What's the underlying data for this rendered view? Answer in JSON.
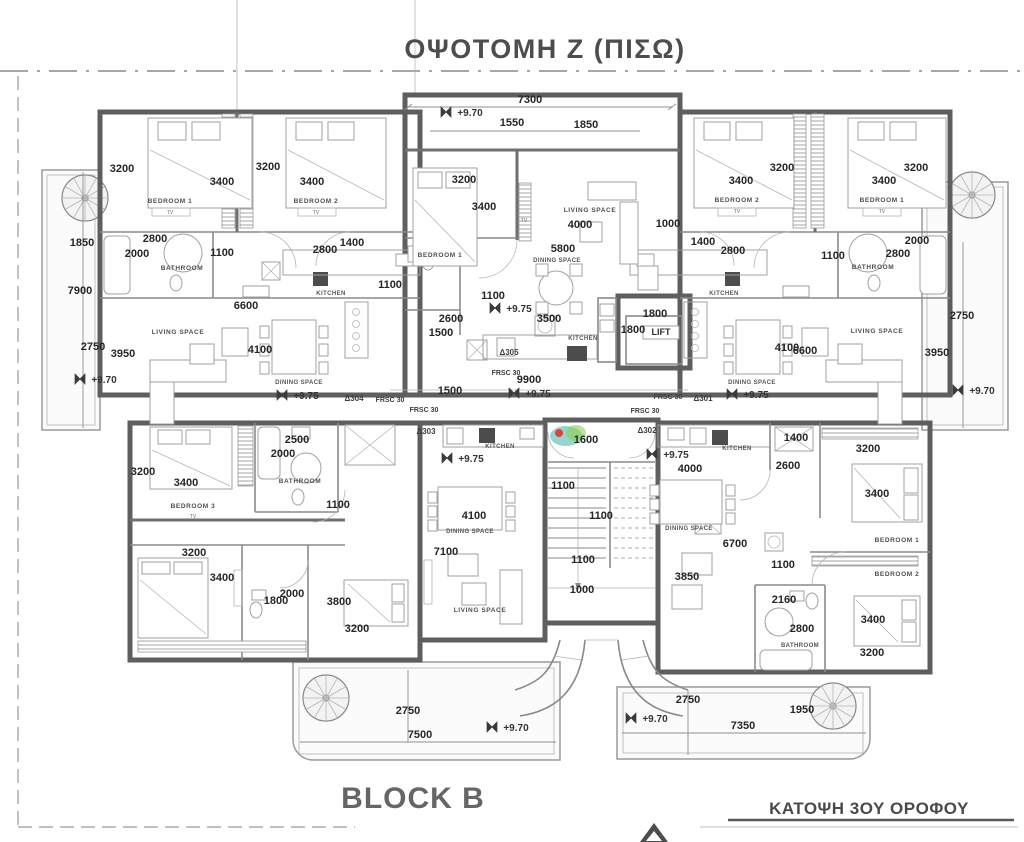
{
  "header": {
    "title": "ΟΨΟΤΟΜΗ Ζ (ΠΙΣΩ)"
  },
  "footer": {
    "block_label": "BLOCK B",
    "plan_label": "ΚΑΤΟΨΗ 3ΟΥ ΟΡΟΦΟΥ"
  },
  "colors": {
    "wall_gray": "#5e5e5e",
    "text_dark": "#262626",
    "stamp_teal": "#6fc7c0",
    "stamp_green": "#8fd14f",
    "stamp_red": "#e04438"
  },
  "annotations": [
    {
      "x": 530,
      "y": 103,
      "t": "7300",
      "k": "dim"
    },
    {
      "x": 470,
      "y": 116,
      "t": "+9.70",
      "k": "level"
    },
    {
      "x": 512,
      "y": 126,
      "t": "1550",
      "k": "dim"
    },
    {
      "x": 586,
      "y": 128,
      "t": "1850",
      "k": "dim"
    },
    {
      "x": 464,
      "y": 183,
      "t": "3200",
      "k": "dim"
    },
    {
      "x": 484,
      "y": 210,
      "t": "3400",
      "k": "dim"
    },
    {
      "x": 440,
      "y": 257,
      "t": "BEDROOM 1",
      "k": "room"
    },
    {
      "x": 590,
      "y": 212,
      "t": "LIVING SPACE",
      "k": "room"
    },
    {
      "x": 580,
      "y": 228,
      "t": "4000",
      "k": "dim"
    },
    {
      "x": 563,
      "y": 252,
      "t": "5800",
      "k": "dim"
    },
    {
      "x": 557,
      "y": 262,
      "t": "DINING SPACE",
      "k": "small"
    },
    {
      "x": 668,
      "y": 227,
      "t": "1000",
      "k": "dim"
    },
    {
      "x": 524,
      "y": 222,
      "t": "TV",
      "k": "tiny"
    },
    {
      "x": 122,
      "y": 172,
      "t": "3200",
      "k": "dim"
    },
    {
      "x": 222,
      "y": 185,
      "t": "3400",
      "k": "dim"
    },
    {
      "x": 268,
      "y": 170,
      "t": "3200",
      "k": "dim"
    },
    {
      "x": 312,
      "y": 185,
      "t": "3400",
      "k": "dim"
    },
    {
      "x": 170,
      "y": 203,
      "t": "BEDROOM 1",
      "k": "room"
    },
    {
      "x": 316,
      "y": 203,
      "t": "BEDROOM 2",
      "k": "room"
    },
    {
      "x": 170,
      "y": 214,
      "t": "TV",
      "k": "tiny"
    },
    {
      "x": 316,
      "y": 214,
      "t": "TV",
      "k": "tiny"
    },
    {
      "x": 155,
      "y": 242,
      "t": "2800",
      "k": "dim"
    },
    {
      "x": 137,
      "y": 257,
      "t": "2000",
      "k": "dim"
    },
    {
      "x": 222,
      "y": 256,
      "t": "1100",
      "k": "dim"
    },
    {
      "x": 182,
      "y": 270,
      "t": "BATHROOM",
      "k": "room"
    },
    {
      "x": 325,
      "y": 253,
      "t": "2800",
      "k": "dim"
    },
    {
      "x": 352,
      "y": 246,
      "t": "1400",
      "k": "dim"
    },
    {
      "x": 331,
      "y": 295,
      "t": "KITCHEN",
      "k": "small"
    },
    {
      "x": 246,
      "y": 309,
      "t": "6600",
      "k": "dim"
    },
    {
      "x": 178,
      "y": 334,
      "t": "LIVING SPACE",
      "k": "room"
    },
    {
      "x": 260,
      "y": 353,
      "t": "4100",
      "k": "dim"
    },
    {
      "x": 299,
      "y": 384,
      "t": "DINING SPACE",
      "k": "small"
    },
    {
      "x": 306,
      "y": 399,
      "t": "+9.75",
      "k": "level"
    },
    {
      "x": 354,
      "y": 401,
      "t": "Δ304",
      "k": "delta"
    },
    {
      "x": 390,
      "y": 288,
      "t": "1100",
      "k": "dim"
    },
    {
      "x": 82,
      "y": 246,
      "t": "1850",
      "k": "dim"
    },
    {
      "x": 80,
      "y": 294,
      "t": "7900",
      "k": "dim"
    },
    {
      "x": 93,
      "y": 350,
      "t": "2750",
      "k": "dim"
    },
    {
      "x": 123,
      "y": 357,
      "t": "3950",
      "k": "dim"
    },
    {
      "x": 104,
      "y": 383,
      "t": "+9.70",
      "k": "level"
    },
    {
      "x": 741,
      "y": 184,
      "t": "3400",
      "k": "dim"
    },
    {
      "x": 782,
      "y": 171,
      "t": "3200",
      "k": "dim"
    },
    {
      "x": 884,
      "y": 184,
      "t": "3400",
      "k": "dim"
    },
    {
      "x": 916,
      "y": 171,
      "t": "3200",
      "k": "dim"
    },
    {
      "x": 737,
      "y": 202,
      "t": "BEDROOM 2",
      "k": "room"
    },
    {
      "x": 882,
      "y": 202,
      "t": "BEDROOM 1",
      "k": "room"
    },
    {
      "x": 737,
      "y": 213,
      "t": "TV",
      "k": "tiny"
    },
    {
      "x": 882,
      "y": 213,
      "t": "TV",
      "k": "tiny"
    },
    {
      "x": 703,
      "y": 245,
      "t": "1400",
      "k": "dim"
    },
    {
      "x": 733,
      "y": 254,
      "t": "2800",
      "k": "dim"
    },
    {
      "x": 833,
      "y": 259,
      "t": "1100",
      "k": "dim"
    },
    {
      "x": 898,
      "y": 257,
      "t": "2800",
      "k": "dim"
    },
    {
      "x": 917,
      "y": 244,
      "t": "2000",
      "k": "dim"
    },
    {
      "x": 873,
      "y": 269,
      "t": "BATHROOM",
      "k": "room"
    },
    {
      "x": 724,
      "y": 295,
      "t": "KITCHEN",
      "k": "small"
    },
    {
      "x": 805,
      "y": 354,
      "t": "6600",
      "k": "dim"
    },
    {
      "x": 787,
      "y": 351,
      "t": "4100",
      "k": "dim"
    },
    {
      "x": 752,
      "y": 384,
      "t": "DINING SPACE",
      "k": "small"
    },
    {
      "x": 756,
      "y": 398,
      "t": "+9.75",
      "k": "level"
    },
    {
      "x": 703,
      "y": 401,
      "t": "Δ301",
      "k": "delta"
    },
    {
      "x": 877,
      "y": 333,
      "t": "LIVING SPACE",
      "k": "room"
    },
    {
      "x": 962,
      "y": 319,
      "t": "2750",
      "k": "dim"
    },
    {
      "x": 937,
      "y": 356,
      "t": "3950",
      "k": "dim"
    },
    {
      "x": 982,
      "y": 394,
      "t": "+9.70",
      "k": "level"
    },
    {
      "x": 493,
      "y": 299,
      "t": "1100",
      "k": "dim"
    },
    {
      "x": 451,
      "y": 322,
      "t": "2600",
      "k": "dim"
    },
    {
      "x": 441,
      "y": 336,
      "t": "1500",
      "k": "dim"
    },
    {
      "x": 519,
      "y": 312,
      "t": "+9.75",
      "k": "level"
    },
    {
      "x": 549,
      "y": 322,
      "t": "3500",
      "k": "dim"
    },
    {
      "x": 583,
      "y": 340,
      "t": "KITCHEN",
      "k": "small"
    },
    {
      "x": 655,
      "y": 317,
      "t": "1800",
      "k": "dim"
    },
    {
      "x": 633,
      "y": 333,
      "t": "1800",
      "k": "dim"
    },
    {
      "x": 661,
      "y": 335,
      "t": "LIFT",
      "k": "lift"
    },
    {
      "x": 509,
      "y": 355,
      "t": "Δ305",
      "k": "delta"
    },
    {
      "x": 506,
      "y": 375,
      "t": "FRSC 30",
      "k": "frsc"
    },
    {
      "x": 529,
      "y": 383,
      "t": "9900",
      "k": "dim"
    },
    {
      "x": 450,
      "y": 394,
      "t": "1500",
      "k": "dim"
    },
    {
      "x": 390,
      "y": 402,
      "t": "FRSC 30",
      "k": "frsc"
    },
    {
      "x": 424,
      "y": 412,
      "t": "FRSC 30",
      "k": "frsc"
    },
    {
      "x": 538,
      "y": 397,
      "t": "+9.75",
      "k": "level"
    },
    {
      "x": 668,
      "y": 399,
      "t": "FRSC 30",
      "k": "frsc"
    },
    {
      "x": 645,
      "y": 413,
      "t": "FRSC 30",
      "k": "frsc"
    },
    {
      "x": 426,
      "y": 434,
      "t": "Δ303",
      "k": "delta"
    },
    {
      "x": 647,
      "y": 433,
      "t": "Δ302",
      "k": "delta"
    },
    {
      "x": 143,
      "y": 475,
      "t": "3200",
      "k": "dim"
    },
    {
      "x": 186,
      "y": 486,
      "t": "3400",
      "k": "dim"
    },
    {
      "x": 193,
      "y": 508,
      "t": "BEDROOM 3",
      "k": "room"
    },
    {
      "x": 193,
      "y": 518,
      "t": "TV",
      "k": "tiny"
    },
    {
      "x": 297,
      "y": 443,
      "t": "2500",
      "k": "dim"
    },
    {
      "x": 283,
      "y": 457,
      "t": "2000",
      "k": "dim"
    },
    {
      "x": 300,
      "y": 483,
      "t": "BATHROOM",
      "k": "room"
    },
    {
      "x": 338,
      "y": 508,
      "t": "1100",
      "k": "dim"
    },
    {
      "x": 194,
      "y": 556,
      "t": "3200",
      "k": "dim"
    },
    {
      "x": 222,
      "y": 581,
      "t": "3400",
      "k": "dim"
    },
    {
      "x": 292,
      "y": 597,
      "t": "2000",
      "k": "dim"
    },
    {
      "x": 276,
      "y": 604,
      "t": "1800",
      "k": "dim"
    },
    {
      "x": 339,
      "y": 605,
      "t": "3800",
      "k": "dim"
    },
    {
      "x": 357,
      "y": 632,
      "t": "3200",
      "k": "dim"
    },
    {
      "x": 408,
      "y": 714,
      "t": "2750",
      "k": "dim"
    },
    {
      "x": 420,
      "y": 738,
      "t": "7500",
      "k": "dim"
    },
    {
      "x": 516,
      "y": 731,
      "t": "+9.70",
      "k": "level"
    },
    {
      "x": 500,
      "y": 448,
      "t": "KITCHEN",
      "k": "small"
    },
    {
      "x": 471,
      "y": 462,
      "t": "+9.75",
      "k": "level"
    },
    {
      "x": 586,
      "y": 443,
      "t": "1600",
      "k": "dim"
    },
    {
      "x": 563,
      "y": 489,
      "t": "1100",
      "k": "dim"
    },
    {
      "x": 474,
      "y": 519,
      "t": "4100",
      "k": "dim"
    },
    {
      "x": 470,
      "y": 533,
      "t": "DINING SPACE",
      "k": "small"
    },
    {
      "x": 446,
      "y": 555,
      "t": "7100",
      "k": "dim"
    },
    {
      "x": 601,
      "y": 519,
      "t": "1100",
      "k": "dim"
    },
    {
      "x": 583,
      "y": 563,
      "t": "1100",
      "k": "dim"
    },
    {
      "x": 480,
      "y": 612,
      "t": "LIVING SPACE",
      "k": "room"
    },
    {
      "x": 582,
      "y": 593,
      "t": "1000",
      "k": "dim"
    },
    {
      "x": 737,
      "y": 450,
      "t": "KITCHEN",
      "k": "small"
    },
    {
      "x": 676,
      "y": 458,
      "t": "+9.75",
      "k": "level"
    },
    {
      "x": 690,
      "y": 472,
      "t": "4000",
      "k": "dim"
    },
    {
      "x": 689,
      "y": 530,
      "t": "DINING SPACE",
      "k": "small"
    },
    {
      "x": 735,
      "y": 547,
      "t": "6700",
      "k": "dim"
    },
    {
      "x": 687,
      "y": 580,
      "t": "3850",
      "k": "dim"
    },
    {
      "x": 783,
      "y": 568,
      "t": "1100",
      "k": "dim"
    },
    {
      "x": 796,
      "y": 441,
      "t": "1400",
      "k": "dim"
    },
    {
      "x": 788,
      "y": 469,
      "t": "2600",
      "k": "dim"
    },
    {
      "x": 868,
      "y": 452,
      "t": "3200",
      "k": "dim"
    },
    {
      "x": 877,
      "y": 497,
      "t": "3400",
      "k": "dim"
    },
    {
      "x": 897,
      "y": 542,
      "t": "BEDROOM 1",
      "k": "room"
    },
    {
      "x": 897,
      "y": 576,
      "t": "BEDROOM 2",
      "k": "room"
    },
    {
      "x": 784,
      "y": 603,
      "t": "2160",
      "k": "dim"
    },
    {
      "x": 802,
      "y": 632,
      "t": "2800",
      "k": "dim"
    },
    {
      "x": 800,
      "y": 647,
      "t": "BATHROOM",
      "k": "small"
    },
    {
      "x": 873,
      "y": 623,
      "t": "3400",
      "k": "dim"
    },
    {
      "x": 872,
      "y": 656,
      "t": "3200",
      "k": "dim"
    },
    {
      "x": 802,
      "y": 713,
      "t": "1950",
      "k": "dim"
    },
    {
      "x": 688,
      "y": 703,
      "t": "2750",
      "k": "dim"
    },
    {
      "x": 655,
      "y": 722,
      "t": "+9.70",
      "k": "level"
    },
    {
      "x": 743,
      "y": 729,
      "t": "7350",
      "k": "dim"
    }
  ]
}
